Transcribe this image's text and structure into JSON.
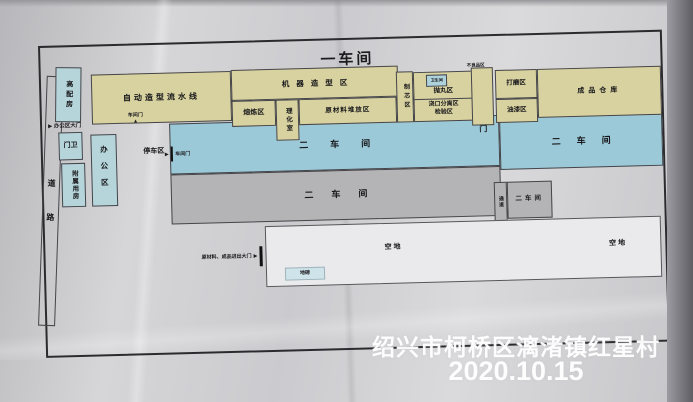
{
  "title": "一车间",
  "icons": {
    "arrow_right": "▶",
    "arrow_up": "▲"
  },
  "colors": {
    "zone_yellow": "#d8d2a0",
    "zone_blue": "#9cc9d8",
    "zone_light_blue": "#b6d5da",
    "zone_gray": "#b4b4b6",
    "zone_white": "#eaeaec",
    "plan_border": "#2b2b2f",
    "watermark_text": "#ffffff"
  },
  "left_area": {
    "road_char1": "道",
    "road_char2": "路",
    "power_room": "高配房",
    "office_gate": "办公区大门",
    "guard": "门卫",
    "aux_rooms": "附属用房",
    "office": "办公区",
    "parking": "停车区",
    "workshop_door_top": "车间门",
    "workshop_door_side": "车间门"
  },
  "workshop1": {
    "auto_molding_line": "自动造型流水线",
    "machine_molding": "机器造型区",
    "smelting": "熔炼区",
    "lab": "理化室",
    "raw_material": "原材料堆放区",
    "core_making": "制芯区",
    "toilet": "卫生间",
    "shot_blasting": "抛丸区",
    "gate_separation": "浇口分离区",
    "inspection": "检验区",
    "defective_area": "不良品区",
    "grinding": "打磨区",
    "painting": "油漆区",
    "warehouse": "成品仓库",
    "door": "门"
  },
  "workshop2": {
    "blue_left": "二车间",
    "blue_right": "二车间",
    "gray_left": "二车间",
    "gray_right": "二车间",
    "passage": "通道"
  },
  "bottom_area": {
    "open_space_left": "空地",
    "open_space_right": "空地",
    "weighbridge": "地磅",
    "material_gate": "原材料、成品进出大门"
  },
  "watermark": {
    "location": "绍兴市柯桥区漓渚镇红星村",
    "date": "2020.10.15"
  }
}
